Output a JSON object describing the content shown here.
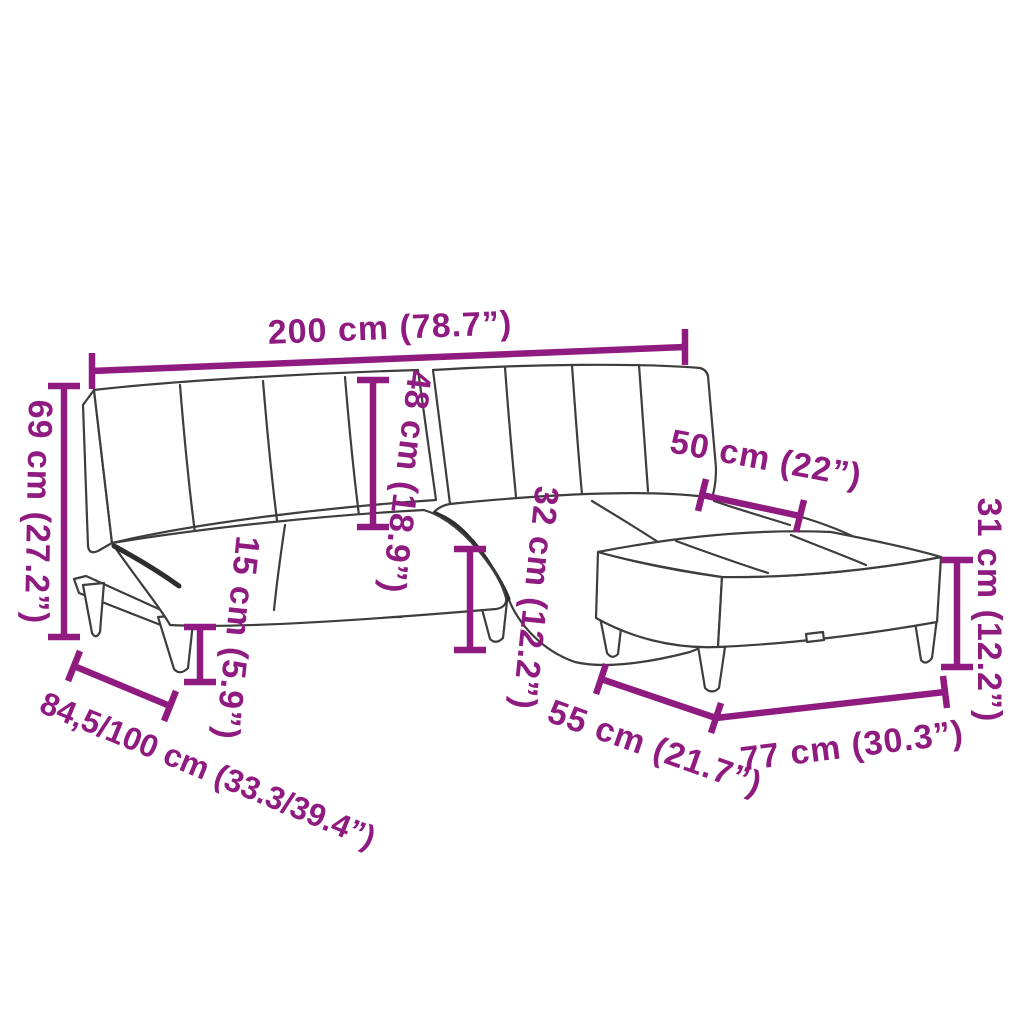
{
  "diagram_title": "Sofa bed with footstool dimension diagram",
  "colors": {
    "annotation": "#8f1a80",
    "outline": "#3d3d3c",
    "background": "#ffffff"
  },
  "measurements": {
    "total_width": {
      "label": "200 cm (78.7”)"
    },
    "backrest_height": {
      "label": "69 cm (27.2”)"
    },
    "backrest_depth": {
      "label": "48 cm (18.9”)"
    },
    "leg_height": {
      "label": "15 cm (5.9”)"
    },
    "seat_height": {
      "label": "32 cm (12.2”)"
    },
    "footstool_depth": {
      "label": "50 cm (22”)"
    },
    "footstool_height": {
      "label": "31 cm (12.2”)"
    },
    "footstool_front": {
      "label": "55 cm (21.7”)"
    },
    "footstool_width": {
      "label": "77 cm (30.3”)"
    },
    "depth_range": {
      "label": "84,5/100 cm (33.3/39.4”)"
    }
  }
}
